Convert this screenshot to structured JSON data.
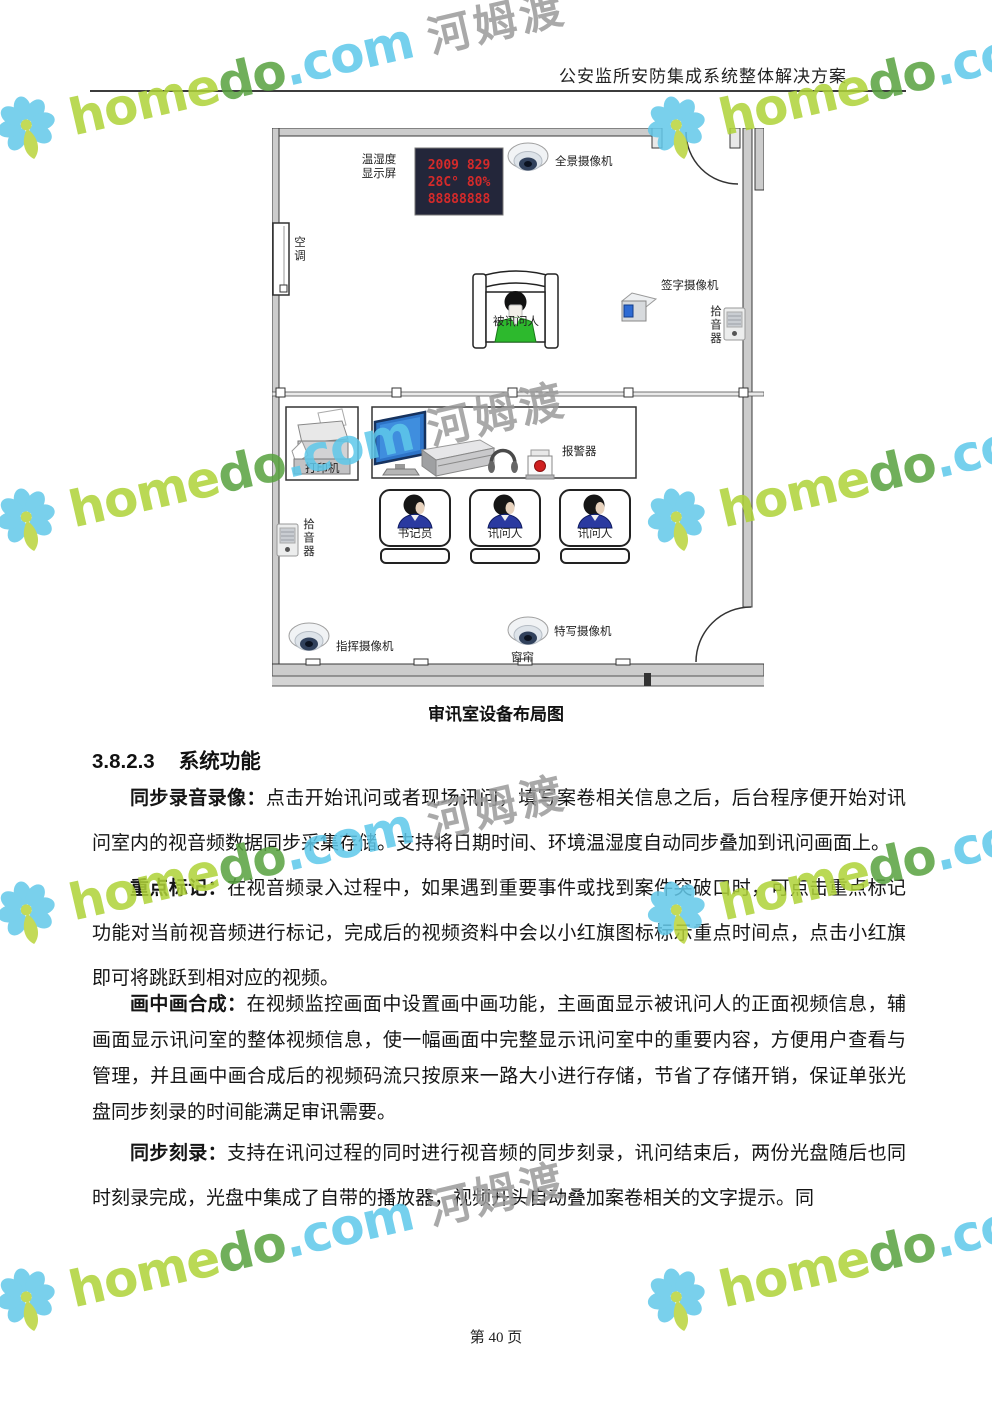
{
  "header": {
    "title": "公安监所安防集成系统整体解决方案"
  },
  "diagram": {
    "caption": "审讯室设备布局图",
    "led": {
      "label_line1": "温湿度",
      "label_line2": "显示屏",
      "line1": "2009 829",
      "line2": "28C° 80%",
      "line3": "88888888"
    },
    "labels": {
      "panoramic_camera": "全景摄像机",
      "air_conditioner": "空调",
      "interrogated_person": "被讯问人",
      "signature_camera": "签字摄像机",
      "pickup_upper": "拾音器",
      "printer": "打印机",
      "alarm": "报警器",
      "clerk": "书记员",
      "interrogator_1": "讯问人",
      "interrogator_2": "讯问人",
      "pickup_lower": "拾音器",
      "command_camera": "指挥摄像机",
      "closeup_camera": "特写摄像机",
      "curtain": "窗帘"
    }
  },
  "section": {
    "number": "3.8.2.3",
    "title": "系统功能"
  },
  "paragraphs": [
    {
      "lead": "同步录音录像：",
      "body": "点击开始讯问或者现场讯问，填写案卷相关信息之后，后台程序便开始对讯问室内的视音频数据同步采集存储。支持将日期时间、环境温湿度自动同步叠加到讯问画面上。"
    },
    {
      "lead": "重点标记：",
      "body": "在视音频录入过程中，如果遇到重要事件或找到案件突破口时，可点击重点标记功能对当前视音频进行标记，完成后的视频资料中会以小红旗图标标示重点时间点，点击小红旗即可将跳跃到相对应的视频。"
    },
    {
      "lead": "画中画合成：",
      "body": "在视频监控画面中设置画中画功能，主画面显示被讯问人的正面视频信息，辅画面显示讯问室的整体视频信息，使一幅画面中完整显示讯问室中的重要内容，方便用户查看与管理，并且画中画合成后的视频码流只按原来一路大小进行存储，节省了存储开销，保证单张光盘同步刻录的时间能满足审讯需要。"
    },
    {
      "lead": "同步刻录：",
      "body": "支持在讯问过程的同时进行视音频的同步刻录，讯问结束后，两份光盘随后也同时刻录完成，光盘中集成了自带的播放器，视频开头自动叠加案卷相关的文字提示。同"
    }
  ],
  "footer": {
    "page_label": "第 40 页"
  },
  "watermark": {
    "brand_home": "home",
    "brand_do": "do",
    "brand_com": ".com",
    "brand_cn": "河姆渡",
    "colors": {
      "home": "#afd338",
      "do": "#58a23f",
      "com": "#5ec8ea",
      "cn": "#9b9b9b",
      "petal": "#62c8e9",
      "petal_accent": "#b9d43b"
    }
  },
  "colors": {
    "led_background": "#23263a",
    "led_digits": "#d42a2a",
    "interrogated_shirt": "#2db92d",
    "staff_shirt": "#2a3aa0",
    "monitor_screen": "#2e74c8",
    "wall": "#cccccc"
  }
}
